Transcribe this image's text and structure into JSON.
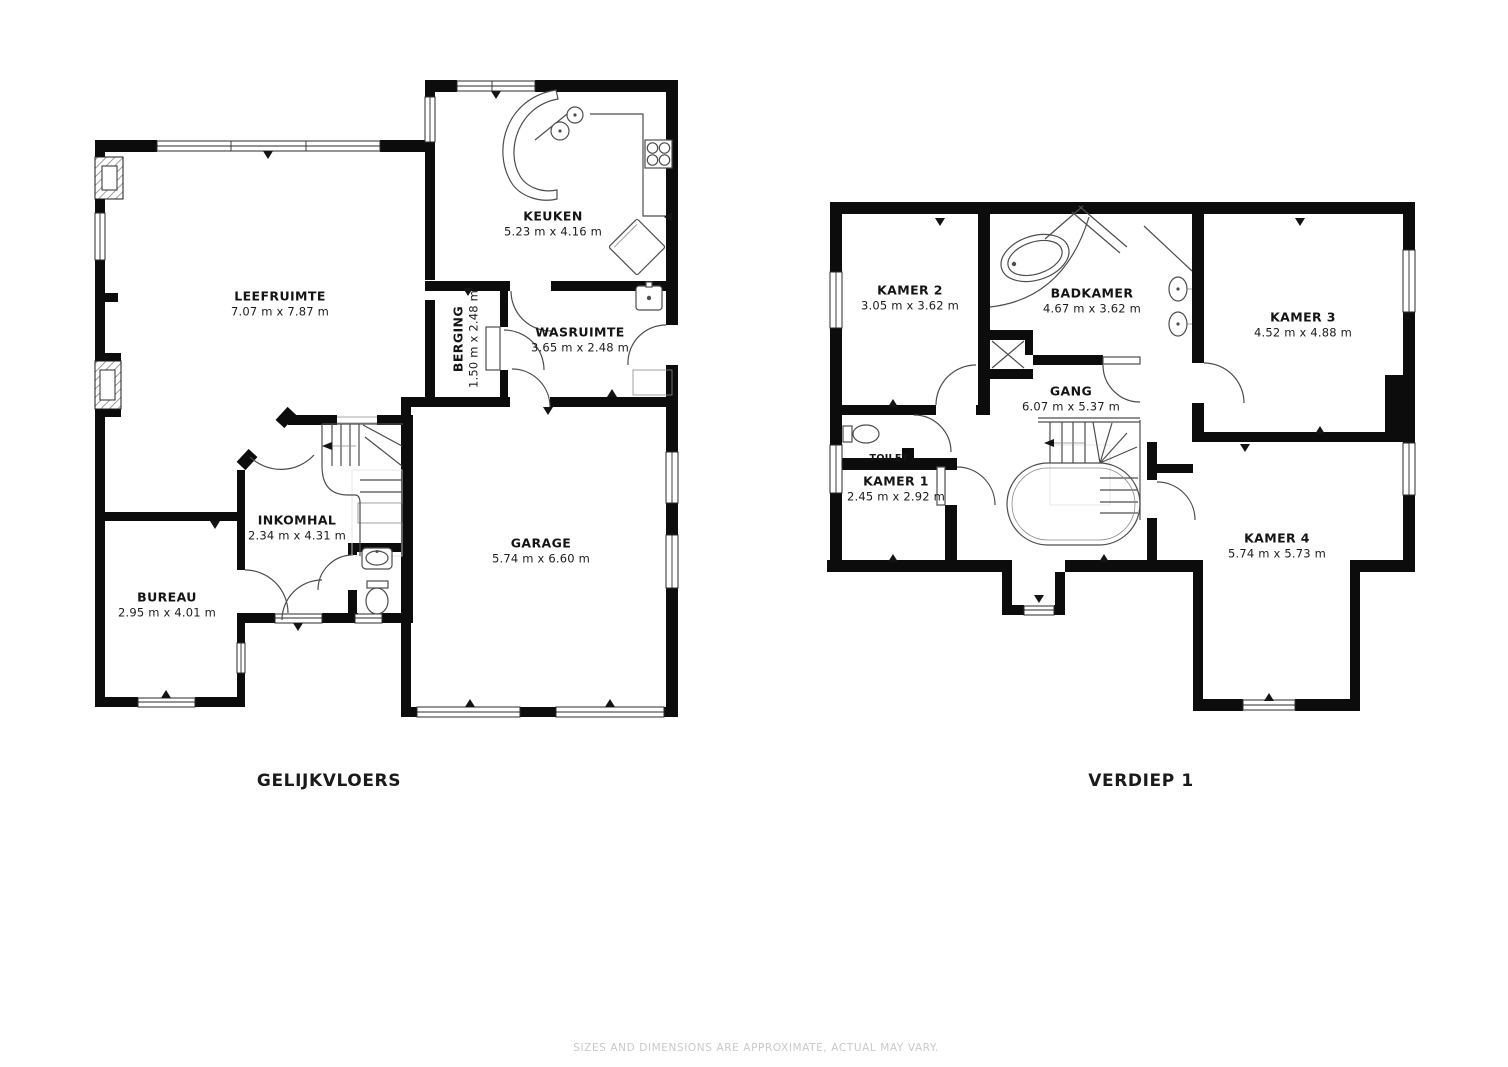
{
  "page": {
    "background": "#ffffff",
    "disclaimer": "SIZES AND DIMENSIONS ARE APPROXIMATE, ACTUAL MAY VARY.",
    "palette": {
      "wall": "#0c0c0c",
      "thin_line": "#4d4d4d",
      "window_line": "#2b2b2b",
      "label_text": "#141414",
      "disclaimer_text": "#c9c9c9"
    }
  },
  "floors": [
    {
      "title": "GELIJKVLOERS",
      "rooms": [
        {
          "name": "LEEFRUIMTE",
          "dims": "7.07 m x 7.87 m"
        },
        {
          "name": "KEUKEN",
          "dims": "5.23 m x 4.16 m"
        },
        {
          "name": "BERGING",
          "dims": "1.50 m x 2.48 m"
        },
        {
          "name": "WASRUIMTE",
          "dims": "3.65 m x 2.48 m"
        },
        {
          "name": "INKOMHAL",
          "dims": "2.34 m x 4.31 m"
        },
        {
          "name": "GARAGE",
          "dims": "5.74 m x 6.60 m"
        },
        {
          "name": "BUREAU",
          "dims": "2.95 m x 4.01 m"
        }
      ]
    },
    {
      "title": "VERDIEP 1",
      "rooms": [
        {
          "name": "KAMER 2",
          "dims": "3.05 m x 3.62 m"
        },
        {
          "name": "BADKAMER",
          "dims": "4.67 m x 3.62 m"
        },
        {
          "name": "KAMER 3",
          "dims": "4.52 m x 4.88 m"
        },
        {
          "name": "TOILET",
          "dims": ""
        },
        {
          "name": "GANG",
          "dims": "6.07 m x 5.37 m"
        },
        {
          "name": "KAMER 1",
          "dims": "2.45 m x 2.92 m"
        },
        {
          "name": "KAMER 4",
          "dims": "5.74 m x 5.73 m"
        }
      ]
    }
  ]
}
